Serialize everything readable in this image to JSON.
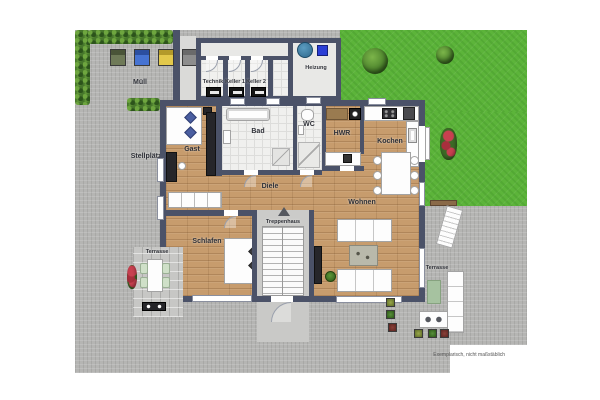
{
  "plan": {
    "disclaimer": "Exemplarisch, nicht maßstäblich",
    "outdoor": {
      "muell_label": "Müll",
      "stellplaetze_label": "Stellplätze",
      "terrasse_left_label": "Terrasse",
      "terrasse_right_label": "Terrasse"
    },
    "outbuilding": {
      "technik_label": "Technik",
      "keller1_label": "Keller 1",
      "keller2_label": "Keller 2",
      "heizung_label": "Heizung"
    },
    "house": {
      "gast_label": "Gast",
      "bad_label": "Bad",
      "wc_label": "WC",
      "hwr_label": "HWR",
      "kochen_label": "Kochen",
      "diele_label": "Diele",
      "treppenhaus_label": "Treppenhaus",
      "wohnen_label": "Wohnen",
      "schlafen_label": "Schlafen"
    },
    "colors": {
      "wall": "#4b5268",
      "wood_floor": "#c79c6d",
      "tile_floor": "#f0f0ee",
      "paving": "#b5b5b3",
      "grass": "#5cb43a",
      "hedge": "#47772c",
      "bin_blue": "#4673d2",
      "bin_yellow": "#e3c94b",
      "heater_tank_blue": "#4a8cb4",
      "heater_unit_blue": "#2b3fd6"
    }
  }
}
